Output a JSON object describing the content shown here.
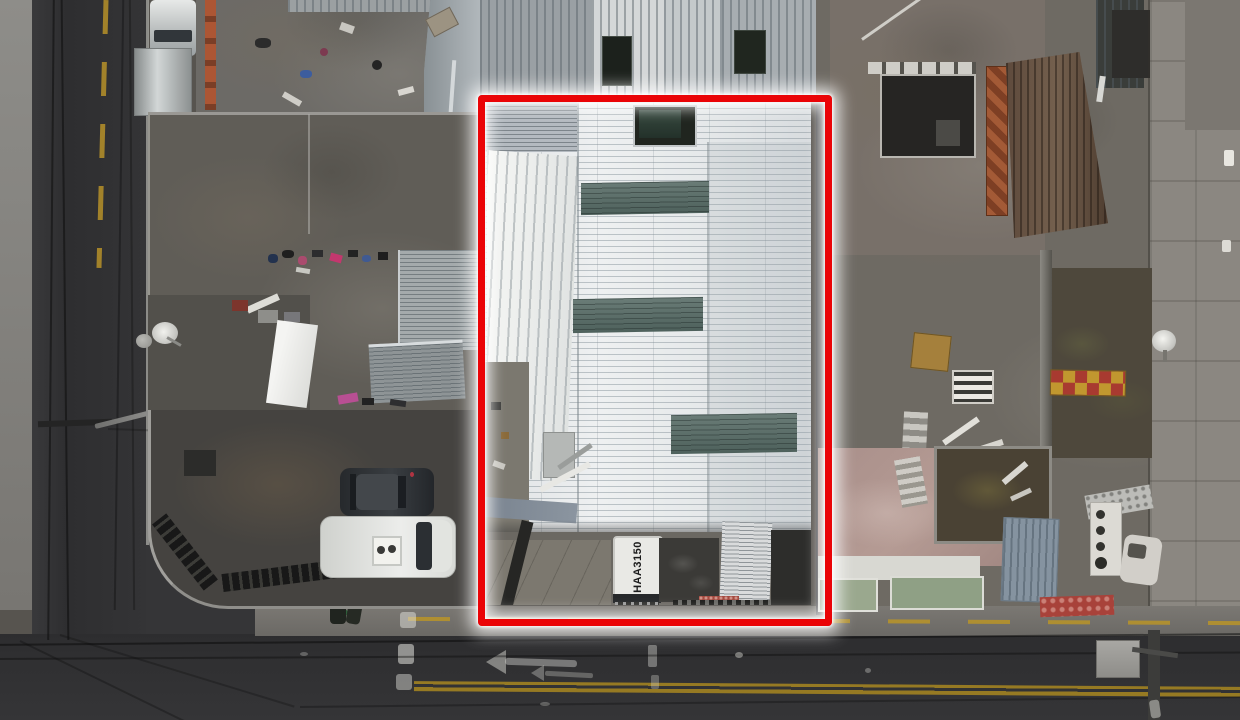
{
  "scene": {
    "truck_roof_text": "HAA3150",
    "highlight_color": "#ea0407",
    "highlight_glow_color": "#ffffff",
    "road_marking_yellow": "#b39027",
    "skylight_green": "#5c6f6b",
    "roof_white": "#e8eaec"
  }
}
